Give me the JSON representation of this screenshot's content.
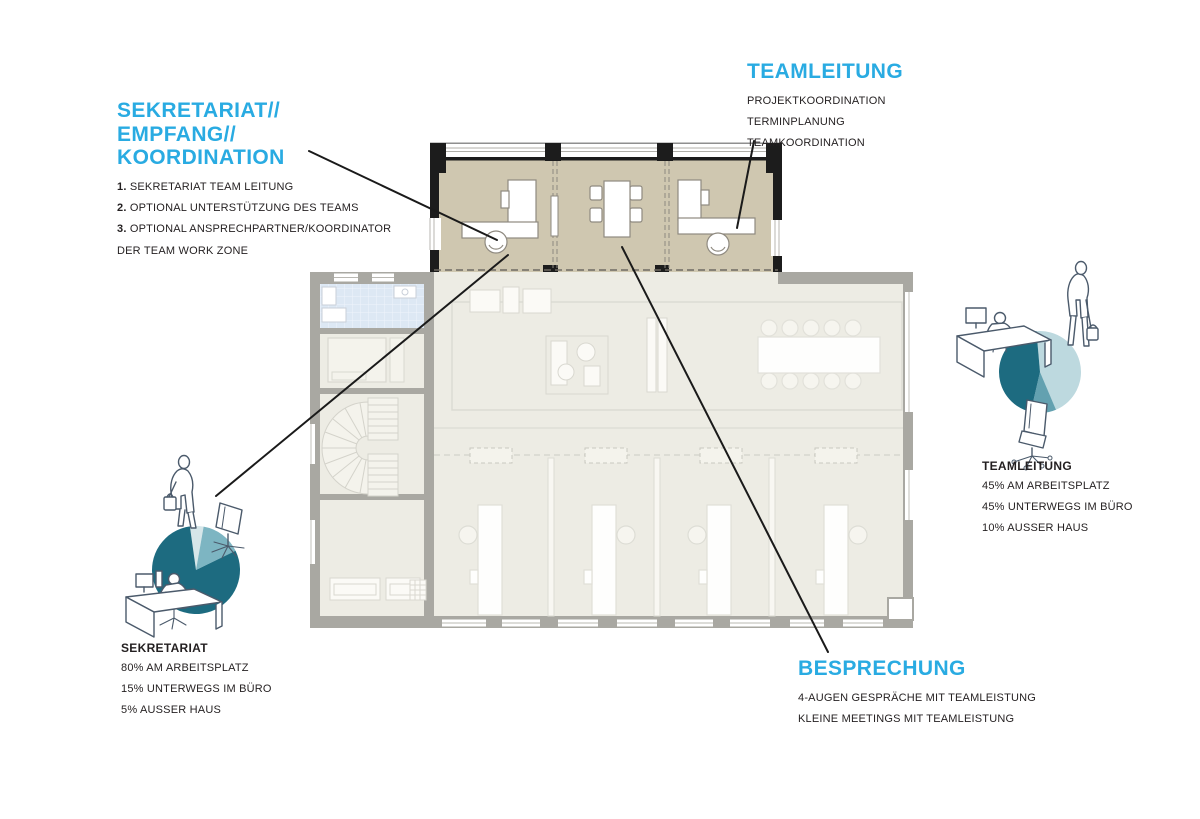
{
  "colors": {
    "accent": "#29abe2",
    "pie_dark": "#1d6b80",
    "pie_mid": "#7db5c2",
    "pie_pale": "#d6e6e9",
    "zone_fill": "#cfc7b0",
    "wall_black": "#1c1c1c",
    "wall_gray": "#a9a8a2"
  },
  "annotations": {
    "sekretariat_zone": {
      "title_lines": [
        "SEKRETARIAT//",
        "EMPFANG//",
        "KOORDINATION"
      ],
      "items": [
        {
          "num": "1.",
          "text": "SEKRETARIAT TEAM LEITUNG"
        },
        {
          "num": "2.",
          "text": "OPTIONAL UNTERSTÜTZUNG DES TEAMS"
        },
        {
          "num": "3.",
          "text": "OPTIONAL ANSPRECHPARTNER/KOORDINATOR"
        },
        {
          "num": "",
          "text": "DER TEAM WORK ZONE"
        }
      ]
    },
    "teamleitung_zone": {
      "title": "TEAMLEITUNG",
      "items": [
        "PROJEKTKOORDINATION",
        "TERMINPLANUNG",
        "TEAMKOORDINATION"
      ]
    },
    "besprechung_zone": {
      "title": "BESPRECHUNG",
      "items": [
        "4-AUGEN GESPRÄCHE MIT TEAMLEISTUNG",
        "KLEINE MEETINGS MIT TEAMLEISTUNG"
      ]
    }
  },
  "stats": {
    "sekretariat": {
      "title": "SEKRETARIAT",
      "items": [
        "80% AM ARBEITSPLATZ",
        "15% UNTERWEGS IM BÜRO",
        "5% AUSSER HAUS"
      ]
    },
    "teamleitung": {
      "title": "TEAMLEITUNG",
      "items": [
        "45% AM ARBEITSPLATZ",
        "45% UNTERWEGS IM BÜRO",
        "10% AUSSER HAUS"
      ]
    }
  },
  "chart_data": [
    {
      "type": "pie",
      "title": "SEKRETARIAT",
      "labels": [
        "AM ARBEITSPLATZ",
        "UNTERWEGS IM BÜRO",
        "AUSSER HAUS"
      ],
      "values": [
        80,
        15,
        5
      ]
    },
    {
      "type": "pie",
      "title": "TEAMLEITUNG",
      "labels": [
        "AM ARBEITSPLATZ",
        "UNTERWEGS IM BÜRO",
        "AUSSER HAUS"
      ],
      "values": [
        45,
        45,
        10
      ]
    }
  ],
  "pies": [
    {
      "name": "sekretariat-pie",
      "cx": 196,
      "cy": 570,
      "r": 44,
      "start": -8,
      "slices": [
        {
          "label": "AUSSER HAUS",
          "value": 5,
          "color": "#d6e6e9"
        },
        {
          "label": "UNTERWEGS IM BÜRO",
          "value": 15,
          "color": "#7db5c2"
        },
        {
          "label": "AM ARBEITSPLATZ",
          "value": 80,
          "color": "#1d6b80"
        }
      ]
    },
    {
      "name": "teamleitung-pie",
      "cx": 1040,
      "cy": 372,
      "r": 41,
      "start": -5,
      "slices": [
        {
          "label": "UNTERWEGS IM BÜRO",
          "value": 45,
          "color": "#bdd9df"
        },
        {
          "label": "AUSSER HAUS",
          "value": 10,
          "color": "#63a1b0"
        },
        {
          "label": "AM ARBEITSPLATZ",
          "value": 45,
          "color": "#1d6b80"
        }
      ]
    }
  ]
}
